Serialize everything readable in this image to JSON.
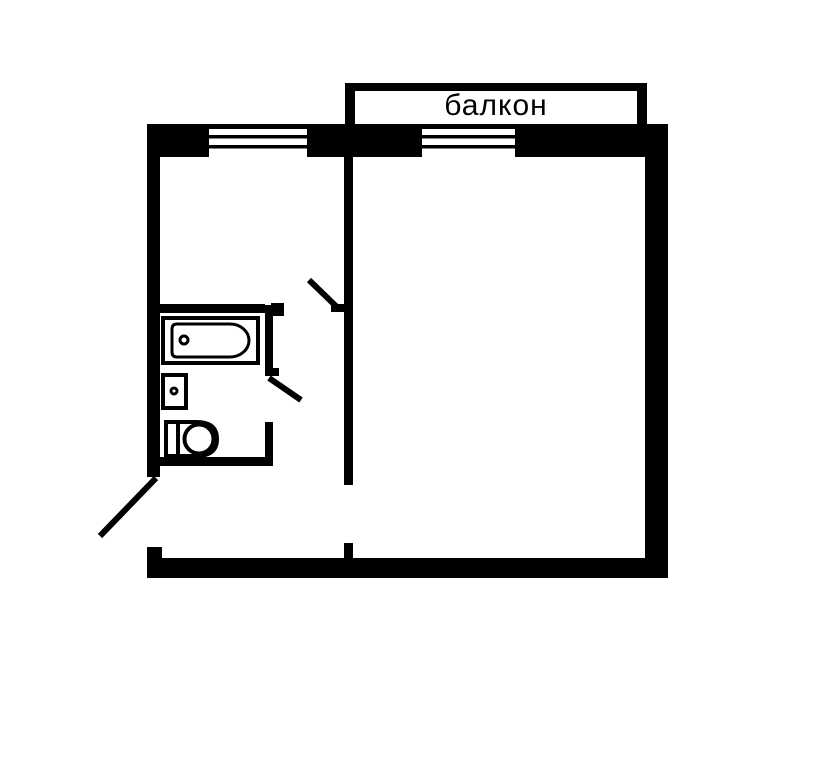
{
  "plan": {
    "balcony_label": "балкон",
    "wall_color": "#000000",
    "background_color": "#ffffff"
  },
  "geometry": {
    "canvas": {
      "width": 827,
      "height": 767
    },
    "shapes": [
      {
        "type": "rect",
        "name": "balcony-left-wall",
        "x": 345,
        "y": 83,
        "w": 10,
        "h": 41,
        "fill": "#000000"
      },
      {
        "type": "rect",
        "name": "balcony-right-wall",
        "x": 637,
        "y": 83,
        "w": 10,
        "h": 41,
        "fill": "#000000"
      },
      {
        "type": "rect",
        "name": "balcony-top-wall",
        "x": 345,
        "y": 83,
        "w": 302,
        "h": 8,
        "fill": "#000000"
      },
      {
        "type": "rect",
        "name": "main-top-wall",
        "x": 147,
        "y": 124,
        "w": 521,
        "h": 33,
        "fill": "#000000"
      },
      {
        "type": "rect",
        "name": "kitchen-window-opening",
        "x": 209,
        "y": 129,
        "w": 98,
        "h": 28,
        "fill": "#ffffff"
      },
      {
        "type": "rect",
        "name": "kitchen-window-pane-line",
        "x": 209,
        "y": 135,
        "w": 98,
        "h": 3.5,
        "fill": "#000000"
      },
      {
        "type": "rect",
        "name": "kitchen-window-sill-line",
        "x": 209,
        "y": 145,
        "w": 98,
        "h": 3.5,
        "fill": "#000000"
      },
      {
        "type": "rect",
        "name": "balcony-window-opening",
        "x": 422,
        "y": 129,
        "w": 93,
        "h": 28,
        "fill": "#ffffff"
      },
      {
        "type": "rect",
        "name": "balcony-window-pane-line",
        "x": 422,
        "y": 135,
        "w": 93,
        "h": 3.5,
        "fill": "#000000"
      },
      {
        "type": "rect",
        "name": "balcony-window-sill-line",
        "x": 422,
        "y": 145,
        "w": 93,
        "h": 3.5,
        "fill": "#000000"
      },
      {
        "type": "rect",
        "name": "left-exterior-wall",
        "x": 147,
        "y": 124,
        "w": 13,
        "h": 353,
        "fill": "#000000"
      },
      {
        "type": "rect",
        "name": "right-exterior-wall",
        "x": 645,
        "y": 124,
        "w": 23,
        "h": 454,
        "fill": "#000000"
      },
      {
        "type": "rect",
        "name": "bottom-exterior-wall",
        "x": 147,
        "y": 558,
        "w": 521,
        "h": 20,
        "fill": "#000000"
      },
      {
        "type": "rect",
        "name": "entrance-door-jamb-stub",
        "x": 147,
        "y": 547,
        "w": 15,
        "h": 31,
        "fill": "#000000"
      },
      {
        "type": "rect",
        "name": "interior-partition-wall",
        "x": 344,
        "y": 157,
        "w": 9,
        "h": 328,
        "fill": "#000000"
      },
      {
        "type": "rect",
        "name": "interior-partition-stub",
        "x": 344,
        "y": 543,
        "w": 9,
        "h": 15,
        "fill": "#000000"
      },
      {
        "type": "rect",
        "name": "kitchen-bathroom-wall",
        "x": 160,
        "y": 304,
        "w": 105,
        "h": 9,
        "fill": "#000000"
      },
      {
        "type": "rect",
        "name": "kitchen-door-jamb-left",
        "x": 271,
        "y": 303,
        "w": 13,
        "h": 13,
        "fill": "#000000"
      },
      {
        "type": "rect",
        "name": "kitchen-door-jamb-right",
        "x": 331,
        "y": 304,
        "w": 13,
        "h": 8,
        "fill": "#000000"
      },
      {
        "type": "line",
        "name": "kitchen-door-leaf",
        "x1": 309,
        "y1": 280,
        "x2": 340,
        "y2": 310,
        "stroke": "#000000",
        "sw": 6
      },
      {
        "type": "rect",
        "name": "bathroom-right-wall-upper",
        "x": 265,
        "y": 305,
        "w": 8,
        "h": 70,
        "fill": "#000000"
      },
      {
        "type": "rect",
        "name": "bathroom-door-jamb-tick",
        "x": 265,
        "y": 368,
        "w": 14,
        "h": 8,
        "fill": "#000000"
      },
      {
        "type": "line",
        "name": "bathroom-door-leaf",
        "x1": 269,
        "y1": 378,
        "x2": 301,
        "y2": 400,
        "stroke": "#000000",
        "sw": 6
      },
      {
        "type": "rect",
        "name": "bathroom-right-wall-lower",
        "x": 265,
        "y": 422,
        "w": 8,
        "h": 40,
        "fill": "#000000"
      },
      {
        "type": "rect",
        "name": "bathroom-bottom-wall",
        "x": 160,
        "y": 457,
        "w": 113,
        "h": 9,
        "fill": "#000000"
      },
      {
        "type": "line",
        "name": "entrance-door-leaf",
        "x1": 156,
        "y1": 478,
        "x2": 100,
        "y2": 536,
        "stroke": "#000000",
        "sw": 6
      },
      {
        "type": "rect",
        "name": "bathtub-outline",
        "x": 163,
        "y": 318,
        "w": 95,
        "h": 45,
        "fill": "#ffffff",
        "stroke": "#000000",
        "sw": 4
      },
      {
        "type": "path",
        "name": "bathtub-basin",
        "d": "M 177 324 L 230 324 A 19 16.5 0 0 1 230 357 L 177 357 Q 172 357 172 352 L 172 329 Q 172 324 177 324 Z",
        "fill": "#ffffff",
        "stroke": "#000000",
        "sw": 3
      },
      {
        "type": "circle",
        "name": "bathtub-drain",
        "cx": 184,
        "cy": 340,
        "r": 4,
        "fill": "#ffffff",
        "stroke": "#000000",
        "sw": 3
      },
      {
        "type": "rect",
        "name": "sink",
        "x": 163,
        "y": 375,
        "w": 23,
        "h": 33,
        "fill": "#ffffff",
        "stroke": "#000000",
        "sw": 4
      },
      {
        "type": "circle",
        "name": "sink-drain",
        "cx": 174,
        "cy": 391,
        "r": 3,
        "fill": "#ffffff",
        "stroke": "#000000",
        "sw": 3
      },
      {
        "type": "path",
        "name": "toilet-body",
        "d": "M 166 422 L 196 422 Q 217 422 217 439 Q 217 456 196 456 L 166 456 Z",
        "fill": "#ffffff",
        "stroke": "#000000",
        "sw": 4
      },
      {
        "type": "line",
        "name": "toilet-tank-line",
        "x1": 178,
        "y1": 423,
        "x2": 178,
        "y2": 455,
        "stroke": "#000000",
        "sw": 4
      },
      {
        "type": "circle",
        "name": "toilet-bowl",
        "cx": 199,
        "cy": 439,
        "r": 14.5,
        "fill": "#ffffff",
        "stroke": "#000000",
        "sw": 4
      }
    ]
  }
}
